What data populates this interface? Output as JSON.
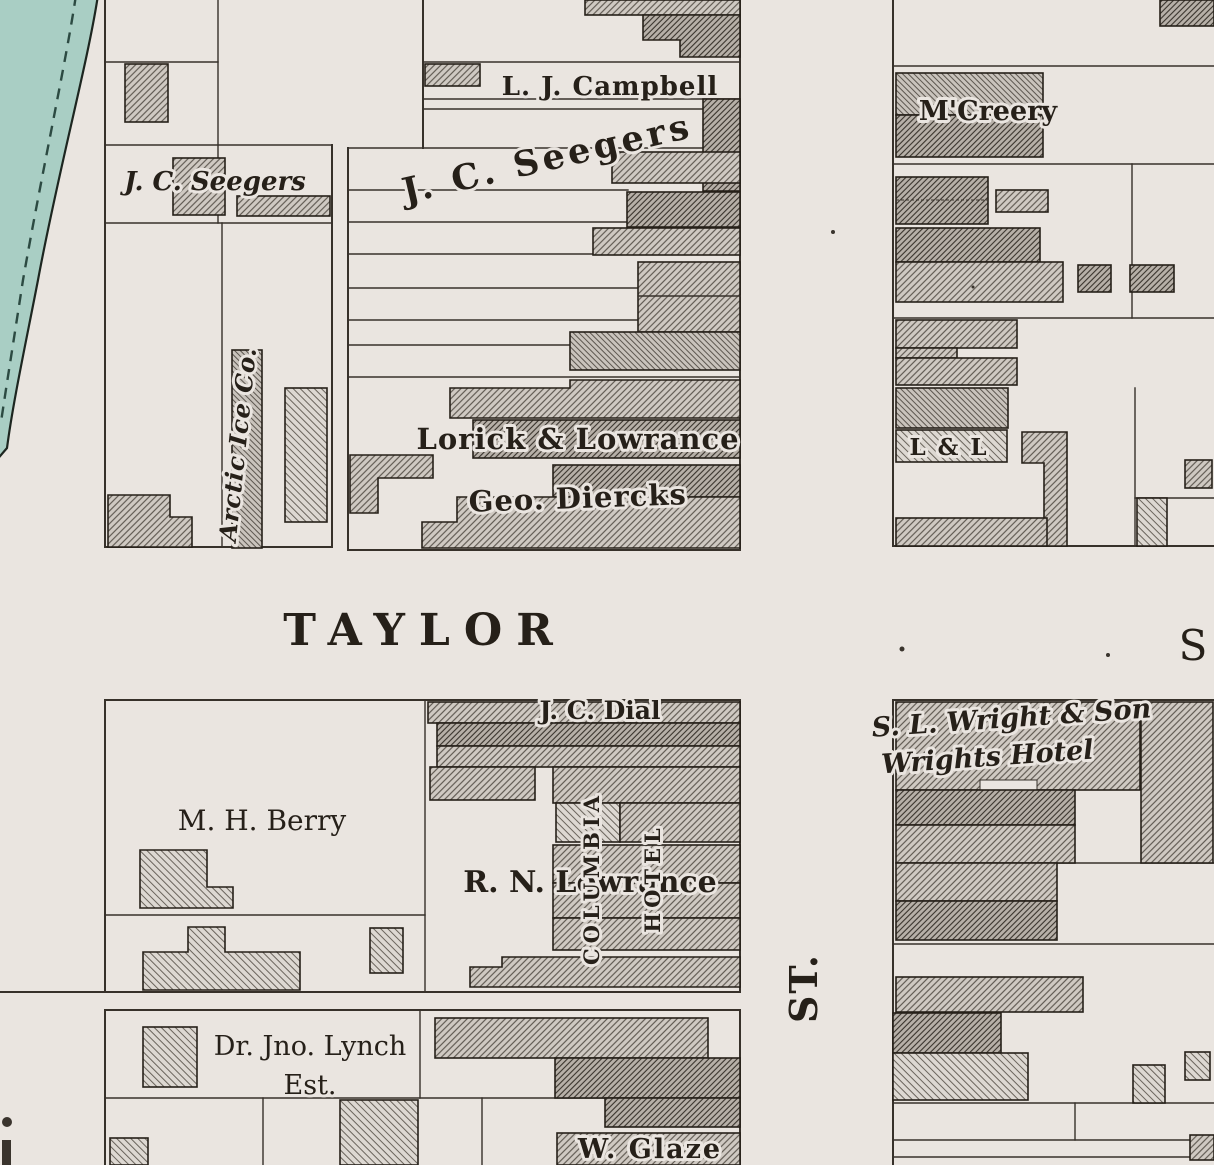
{
  "streets": {
    "taylor": "TAYLOR",
    "s_partial": "S",
    "st_vertical": "ST."
  },
  "blocks": {
    "northwest": {
      "seegers_small": "J. C. Seegers",
      "arctic_ice": "Arctic Ice Co."
    },
    "north_center": {
      "campbell": "L. J. Campbell",
      "seegers_large": "J. C. Seegers",
      "lorick_lowrance": "Lorick & Lowrance",
      "geo_diercks": "Geo. Diercks"
    },
    "northeast": {
      "mccreery": "M'Creery",
      "l_and_l": "L & L"
    },
    "southwest": {
      "berry": "M. H. Berry",
      "dial": "J. C. Dial",
      "rn_lowrance": "R. N. Lowrance",
      "columbia_vertical": "COLUMBIA",
      "hotel_vertical": "HOTEL",
      "lynch_line1": "Dr. Jno. Lynch",
      "lynch_line2": "Est.",
      "glaze": "W. Glaze"
    },
    "southeast": {
      "wright_line1": "S. L. Wright & Son",
      "wright_line2": "Wrights Hotel"
    }
  },
  "colors": {
    "paper": "#eae5e0",
    "ink": "#262019",
    "water": "#a9cec4",
    "hatch_light": "#ddd8d2",
    "hatch_medium": "#cfc9c2",
    "hatch_dark": "#b7b0a8",
    "hatch_warm": "#c9c3bc"
  }
}
